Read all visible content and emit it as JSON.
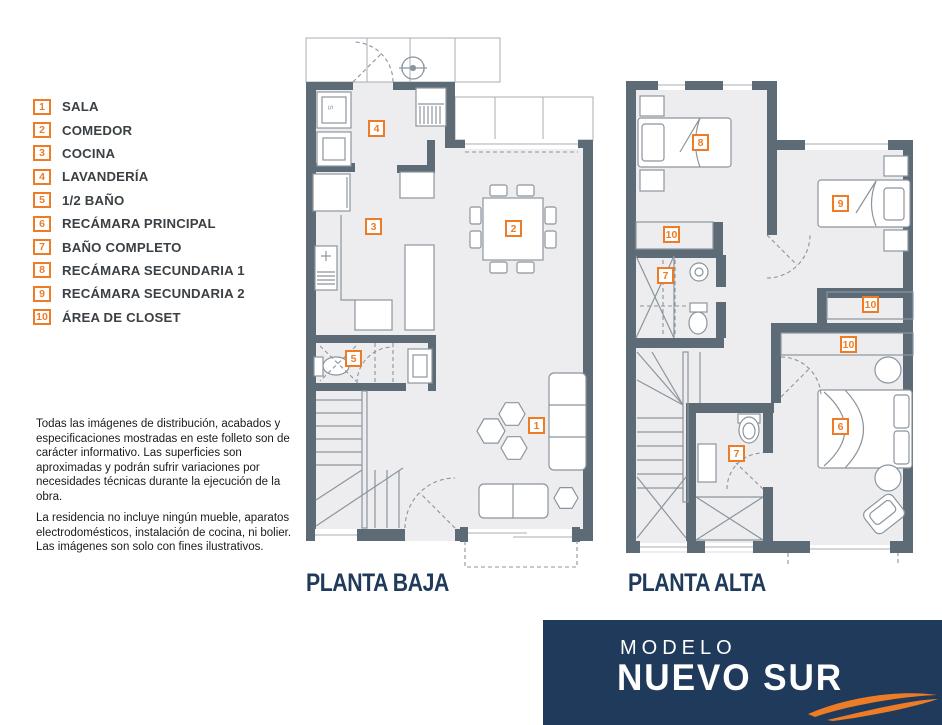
{
  "legend": {
    "items": [
      {
        "n": "1",
        "label": "SALA"
      },
      {
        "n": "2",
        "label": "COMEDOR"
      },
      {
        "n": "3",
        "label": "COCINA"
      },
      {
        "n": "4",
        "label": "LAVANDERÍA"
      },
      {
        "n": "5",
        "label": "1/2 BAÑO"
      },
      {
        "n": "6",
        "label": "RECÁMARA PRINCIPAL"
      },
      {
        "n": "7",
        "label": "BAÑO COMPLETO"
      },
      {
        "n": "8",
        "label": "RECÁMARA SECUNDARIA 1"
      },
      {
        "n": "9",
        "label": "RECÁMARA SECUNDARIA 2"
      },
      {
        "n": "10",
        "label": "ÁREA DE CLOSET"
      }
    ]
  },
  "disclaimer": {
    "p1": "Todas las imágenes de distribución, acabados y especificaciones mostradas en este folleto son de carácter informativo. Las superficies son aproximadas y podrán sufrir variaciones por necesidades técnicas durante la ejecución de la obra.",
    "p2": "La residencia no incluye ningún mueble, aparatos electrodomésticos, instalación de cocina, ni bolier. Las imágenes son solo con fines ilustrativos."
  },
  "plans": {
    "baja": {
      "title": "PLANTA BAJA",
      "appliance_label": "S",
      "markers": [
        {
          "n": "4",
          "room": "lavandería"
        },
        {
          "n": "3",
          "room": "cocina"
        },
        {
          "n": "2",
          "room": "comedor"
        },
        {
          "n": "5",
          "room": "1/2 baño"
        },
        {
          "n": "1",
          "room": "sala"
        }
      ]
    },
    "alta": {
      "title": "PLANTA ALTA",
      "markers": [
        {
          "n": "8",
          "room": "recámara secundaria 1"
        },
        {
          "n": "9",
          "room": "recámara secundaria 2"
        },
        {
          "n": "10",
          "room": "área de closet"
        },
        {
          "n": "7",
          "room": "baño completo"
        },
        {
          "n": "10",
          "room": "área de closet"
        },
        {
          "n": "10",
          "room": "área de closet"
        },
        {
          "n": "6",
          "room": "recámara principal"
        },
        {
          "n": "7",
          "room": "baño completo"
        }
      ]
    }
  },
  "footer": {
    "line1": "MODELO",
    "line2": "NUEVO SUR"
  },
  "colors": {
    "orange": "#EE7C26",
    "navy": "#1F3A5A",
    "wall": "#5D6B76",
    "floor": "#EDEDEF",
    "furniture": "#8B959D"
  }
}
